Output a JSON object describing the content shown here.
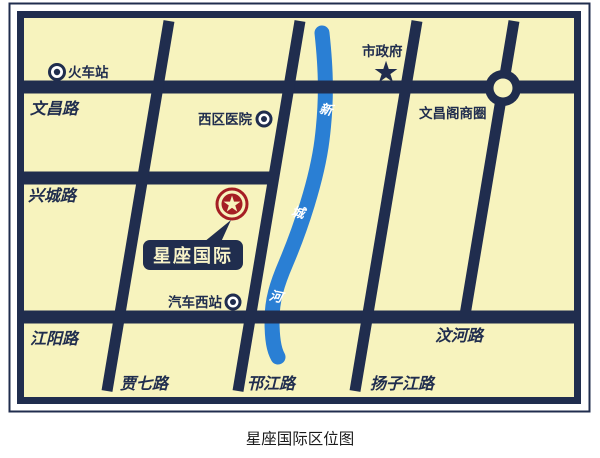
{
  "title_caption": "星座国际区位图",
  "map": {
    "colors": {
      "background": "#F7F3BE",
      "road": "#202D4E",
      "river": "#2A7FD4",
      "marker_red": "#A51E24",
      "label_light": "#F7F3C8",
      "white": "#FFFFFF"
    },
    "pois": {
      "train_station": "火车站",
      "hospital": "西区医院",
      "bus_station": "汽车西站",
      "city_government": "市政府",
      "business_district": "文昌阁商圈"
    },
    "roads": {
      "wenchang": "文昌路",
      "xingcheng": "兴城路",
      "jiangyang": "江阳路",
      "wenhe": "汶河路",
      "jiaqi": "贾七路",
      "hanjiang": "邗江路",
      "yangzijiang": "扬子江路"
    },
    "river_chars": {
      "c1": "新",
      "c2": "城",
      "c3": "河"
    },
    "project_label": "星座国际",
    "icons": {
      "star": "★"
    }
  }
}
